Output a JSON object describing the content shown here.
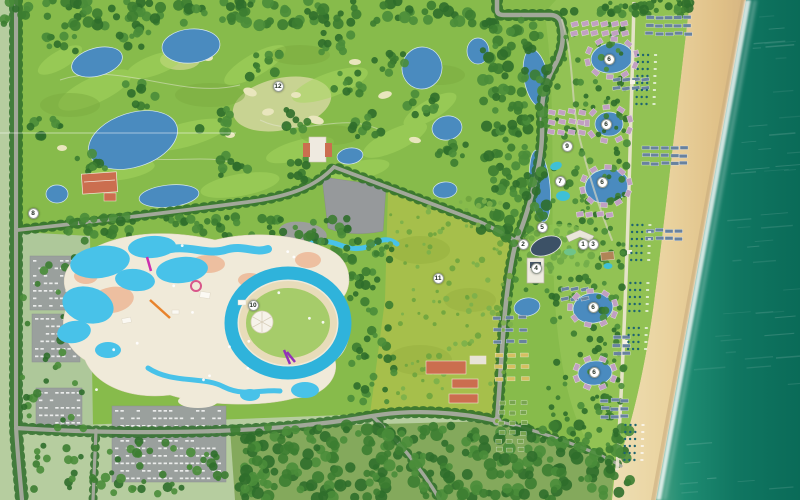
{
  "map": {
    "alt": "Aerial masterplan rendering of a beachfront resort with golf course, water park, hotel zone and villa clusters along a sandy beach and teal sea",
    "markers": [
      {
        "label": "12",
        "x": 278,
        "y": 86
      },
      {
        "label": "8",
        "x": 33,
        "y": 213
      },
      {
        "label": "9",
        "x": 567,
        "y": 146
      },
      {
        "label": "7",
        "x": 560,
        "y": 181
      },
      {
        "label": "5",
        "x": 542,
        "y": 227
      },
      {
        "label": "2",
        "x": 523,
        "y": 244
      },
      {
        "label": "1",
        "x": 583,
        "y": 244
      },
      {
        "label": "3",
        "x": 593,
        "y": 244
      },
      {
        "label": "4",
        "x": 536,
        "y": 268
      },
      {
        "label": "10",
        "x": 253,
        "y": 305
      },
      {
        "label": "11",
        "x": 438,
        "y": 278
      },
      {
        "label": "6",
        "x": 609,
        "y": 59
      },
      {
        "label": "6",
        "x": 606,
        "y": 124
      },
      {
        "label": "6",
        "x": 602,
        "y": 182
      },
      {
        "label": "6",
        "x": 593,
        "y": 307
      },
      {
        "label": "6",
        "x": 594,
        "y": 372
      }
    ],
    "colors": {
      "ocean_deep": "#0a6b58",
      "ocean_shallow": "#4aa183",
      "sand": "#ead39f",
      "surf": "#ffffff",
      "grass": "#87bb4b",
      "golf_fairway": "#a8d75f",
      "pale_field": "#b6cd9f",
      "olive_field": "#a6bf4b",
      "forest": "#2f6e2b",
      "lake": "#4a8bbf",
      "pool": "#48c2e9",
      "lazy_river": "#2fb3db",
      "deck": "#f0ead9",
      "salmon": "#edbd9e",
      "road": "#a8aba0",
      "parking": "#9aa09d",
      "villa_pink": "#c1a0c2",
      "villa_blue": "#68829f",
      "villa_yellow": "#d5bf62",
      "cabin_green": "#79a450",
      "roof_red": "#cb6e4f",
      "marker_bg": "#ffffff",
      "marker_text": "#243024",
      "marker_border": "#98a095"
    }
  }
}
